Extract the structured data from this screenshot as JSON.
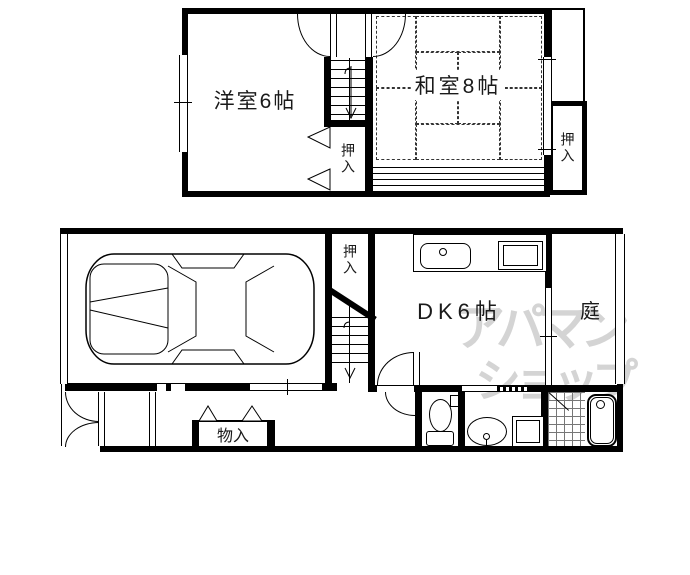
{
  "floor_plan": {
    "upper_floor": {
      "rooms": [
        {
          "name": "western-room",
          "label": "洋室6帖"
        },
        {
          "name": "japanese-room",
          "label": "和室8帖"
        },
        {
          "name": "closet-center",
          "label": "押入"
        },
        {
          "name": "closet-right",
          "label": "押入"
        }
      ]
    },
    "lower_floor": {
      "rooms": [
        {
          "name": "dining-kitchen",
          "label": "DK6帖"
        },
        {
          "name": "garden",
          "label": "庭"
        },
        {
          "name": "closet",
          "label": "押入"
        },
        {
          "name": "storage",
          "label": "物入"
        }
      ]
    },
    "watermark": {
      "line1": "アパマン",
      "line2": "ショップ",
      "color": "#d4d4d4"
    },
    "fixtures": [
      "car",
      "stairs-upper",
      "stairs-lower",
      "kitchen-sink",
      "stove",
      "toilet",
      "washbasin",
      "washing-machine",
      "bathtub",
      "tiled-floor",
      "balcony",
      "veranda",
      "entrance-door",
      "garage-shutter"
    ],
    "colors": {
      "wall": "#000000",
      "background": "#ffffff",
      "tatami_dash": "#333333"
    }
  }
}
